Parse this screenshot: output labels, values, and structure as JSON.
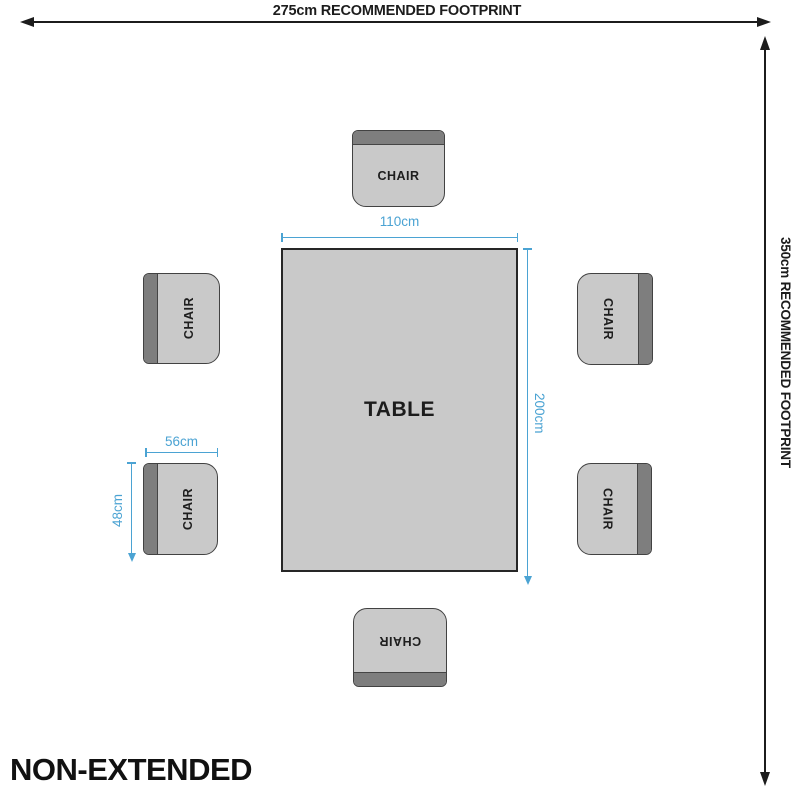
{
  "page": {
    "title": "NON-EXTENDED"
  },
  "footprint": {
    "width_label": "275cm RECOMMENDED FOOTPRINT",
    "depth_label": "350cm RECOMMENDED FOOTPRINT"
  },
  "table": {
    "label": "TABLE",
    "width_label": "110cm",
    "length_label": "200cm"
  },
  "chairs": [
    {
      "position": "top",
      "label": "CHAIR"
    },
    {
      "position": "upper-left",
      "label": "CHAIR"
    },
    {
      "position": "upper-right",
      "label": "CHAIR"
    },
    {
      "position": "lower-left",
      "label": "CHAIR"
    },
    {
      "position": "lower-right",
      "label": "CHAIR"
    },
    {
      "position": "bottom",
      "label": "CHAIR"
    }
  ],
  "chair_dimensions": {
    "width_label": "56cm",
    "depth_label": "48cm"
  },
  "colors": {
    "accent": "#4BA3D3",
    "furniture-fill": "#C9C9C9",
    "backrest-fill": "#7E7E7E",
    "line": "#1C1C1C"
  }
}
